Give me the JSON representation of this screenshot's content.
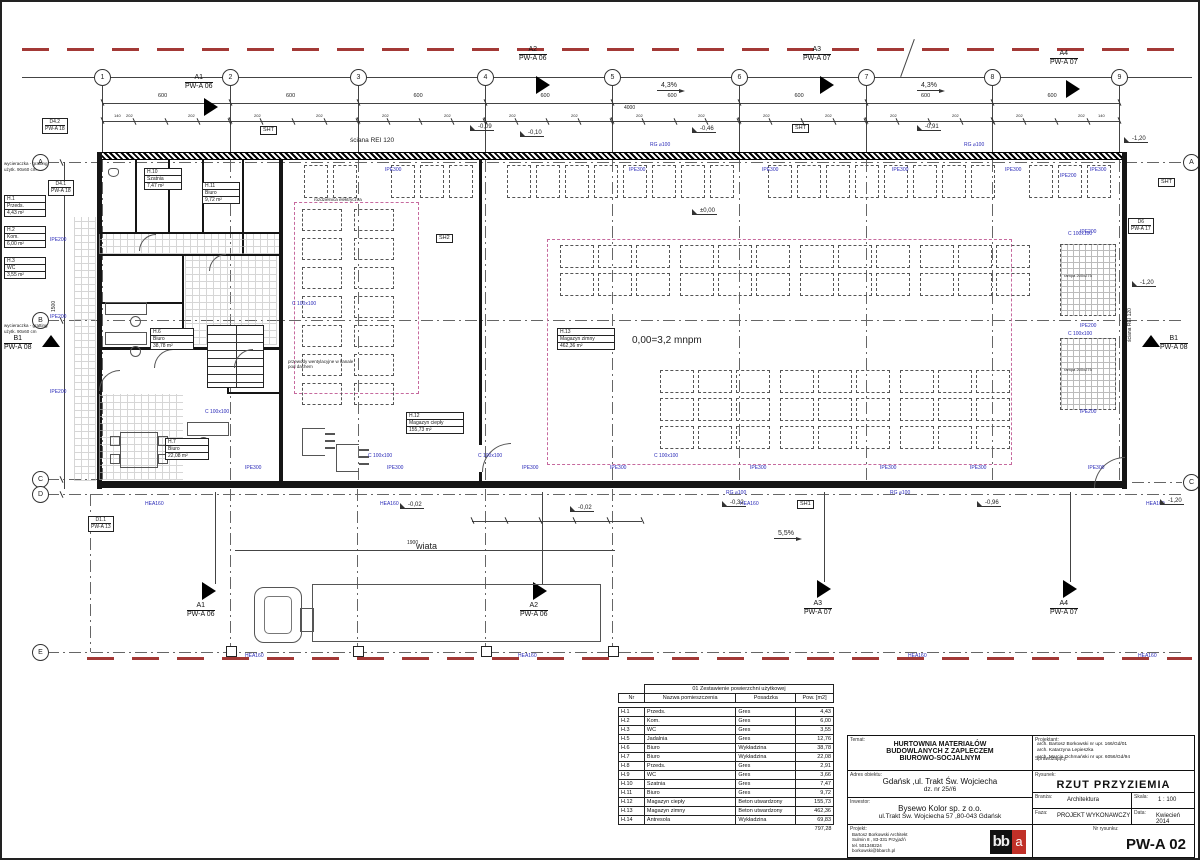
{
  "drawing": {
    "datum_note": "0,00=3,2 mnpm",
    "wiata_label": "wiata",
    "wall_note": "ściana REI 120",
    "doormat_note_1": "wycieraczka - gratting",
    "doormat_note_2": "użytk. 90x60 cm",
    "slope_43": "4,3%",
    "slope_55": "5,5%",
    "dim_600": "600",
    "dim_4000": "4000",
    "dim_202": "202",
    "dim_140": "140",
    "dim_1900": "1900",
    "dim_1500": "1500",
    "levels": {
      "l009": "-0,09",
      "l010": "-0,10",
      "l046": "-0,46",
      "l091": "-0,91",
      "l120": "-1,20",
      "l000": "±0,00",
      "l002": "-0,02",
      "l032": "-0,32",
      "l096": "-0,96"
    },
    "steel": {
      "ipe300": "IPE300",
      "ipe200": "IPE200",
      "hea160": "HEA160",
      "c100": "C 100x100",
      "rg100": "RG ⌀100"
    },
    "shafts": {
      "sht": "SHT",
      "sh1": "SH1",
      "sh2": "SH2"
    },
    "refs": {
      "d42": "D4.2",
      "d41": "D4.1",
      "pwa18": "PW-A 18",
      "d11": "D1.1",
      "pwa13": "PW-A 13",
      "d6": "D6",
      "pwa17": "PW-A 17"
    },
    "sections": {
      "a1": "A1",
      "a2": "A2",
      "a3": "A3",
      "a4": "A4",
      "b1": "B1",
      "s06": "PW-A 06",
      "s07": "PW-A 07",
      "s08": "PW-A 08"
    },
    "grid_cols": [
      "1",
      "2",
      "3",
      "4",
      "5",
      "6",
      "7",
      "8",
      "9"
    ],
    "grid_rows_left": [
      "A",
      "B",
      "C",
      "D",
      "E"
    ],
    "grid_rows_right": [
      "A",
      "C"
    ],
    "rooms": {
      "h1": {
        "nr": "H.1",
        "name": "Przeds.",
        "area": "4,43 m²"
      },
      "h2": {
        "nr": "H.2",
        "name": "Kom.",
        "area": "6,00 m²"
      },
      "h3": {
        "nr": "H.3",
        "name": "WC",
        "area": "3,55 m²"
      },
      "h6": {
        "nr": "H.6",
        "name": "Biuro",
        "area": "38,78 m²"
      },
      "h7": {
        "nr": "H.7",
        "name": "Biuro",
        "area": "22,08 m²"
      },
      "h10": {
        "nr": "H.10",
        "name": "Szatnia",
        "area": "7,47 m²"
      },
      "h11": {
        "nr": "H.11",
        "name": "Biuro",
        "area": "9,72 m²"
      },
      "h12": {
        "nr": "H.12",
        "name": "Magazyn ciepły",
        "area": "155,73 m²"
      },
      "h13": {
        "nr": "H.13",
        "name": "Magazyn zimny",
        "area": "462,36 m²"
      }
    },
    "ramp_label": "rampa 200x275",
    "notes": {
      "rozdzielnica": "rozdzielnica elektryczna",
      "przewody": "przewody wentylacyjne w kanale pod dachem"
    }
  },
  "area_table": {
    "title": "01 Zestawienie powierzchni użytkowej",
    "headers": [
      "Nr",
      "Nazwa pomieszczenia",
      "Posadzka",
      "Pow. [m2]"
    ],
    "rows": [
      [
        "H.1",
        "Przeds.",
        "Gres",
        "4,43"
      ],
      [
        "H.2",
        "Kom.",
        "Gres",
        "6,00"
      ],
      [
        "H.3",
        "WC",
        "Gres",
        "3,55"
      ],
      [
        "H.5",
        "Jadalnia",
        "Gres",
        "12,76"
      ],
      [
        "H.6",
        "Biuro",
        "Wykładzina",
        "38,78"
      ],
      [
        "H.7",
        "Biuro",
        "Wykładzina",
        "22,08"
      ],
      [
        "H.8",
        "Przeds.",
        "Gres",
        "2,91"
      ],
      [
        "H.9",
        "WC",
        "Gres",
        "3,66"
      ],
      [
        "H.10",
        "Szatnia",
        "Gres",
        "7,47"
      ],
      [
        "H.11",
        "Biuro",
        "Gres",
        "9,72"
      ],
      [
        "H.12",
        "Magazyn ciepły",
        "Beton utwardzony",
        "155,73"
      ],
      [
        "H.13",
        "Magazyn zimny",
        "Beton utwardzony",
        "462,36"
      ],
      [
        "H.14",
        "Antresola",
        "Wykładzina",
        "69,83"
      ]
    ],
    "total": "797,28"
  },
  "title_block": {
    "temat_label": "Temat:",
    "temat_lines": [
      "HURTOWNIA MATERIAŁÓW",
      "BUDOWLANYCH Z ZAPLECZEM",
      "BIUROWO-SOCJALNYM"
    ],
    "adres_label": "Adres obiektu:",
    "adres_lines": [
      "Gdańsk ,ul. Trakt Św. Wojciecha",
      "dz. nr 25//6"
    ],
    "inwestor_label": "Inwestor:",
    "inwestor_lines": [
      "Bysewo Kolor sp. z o.o.",
      "ul.Trakt Św. Wojciecha 57 ,80-043 Gdańsk"
    ],
    "projekt_label": "Projekt:",
    "projekt_lines": [
      "Bartosz Borkowski Architekt",
      "Sulmin 8 , 83-331 Przyjaźń",
      "tel. 501348224",
      "borkowski@bbarch.pl"
    ],
    "projektant_label": "Projektant:",
    "projektant_lines": [
      "arch. Bartosz Borkowski nr upr. 166/Gd/01",
      "arch. Katarzyna Lepieszka"
    ],
    "sprawdzajacy_label": "Sprawdzający:",
    "sprawdzajacy_lines": [
      "arch. Marcin Ochmański nr upr. 6056/Gd/94"
    ],
    "rysunek_label": "Rysunek:",
    "rysunek": "RZUT PRZYZIEMIA",
    "branza_label": "Branża:",
    "branza": "Architektura",
    "skala_label": "Skala:",
    "skala": "1 : 100",
    "faza_label": "Faza:",
    "faza": "PROJEKT WYKONAWCZY",
    "data_label": "Data:",
    "data": "Kwiecień 2014",
    "nr_label": "Nr rysunku:",
    "nr": "PW-A 02",
    "logo_bb": "bb",
    "logo_a": "a"
  }
}
